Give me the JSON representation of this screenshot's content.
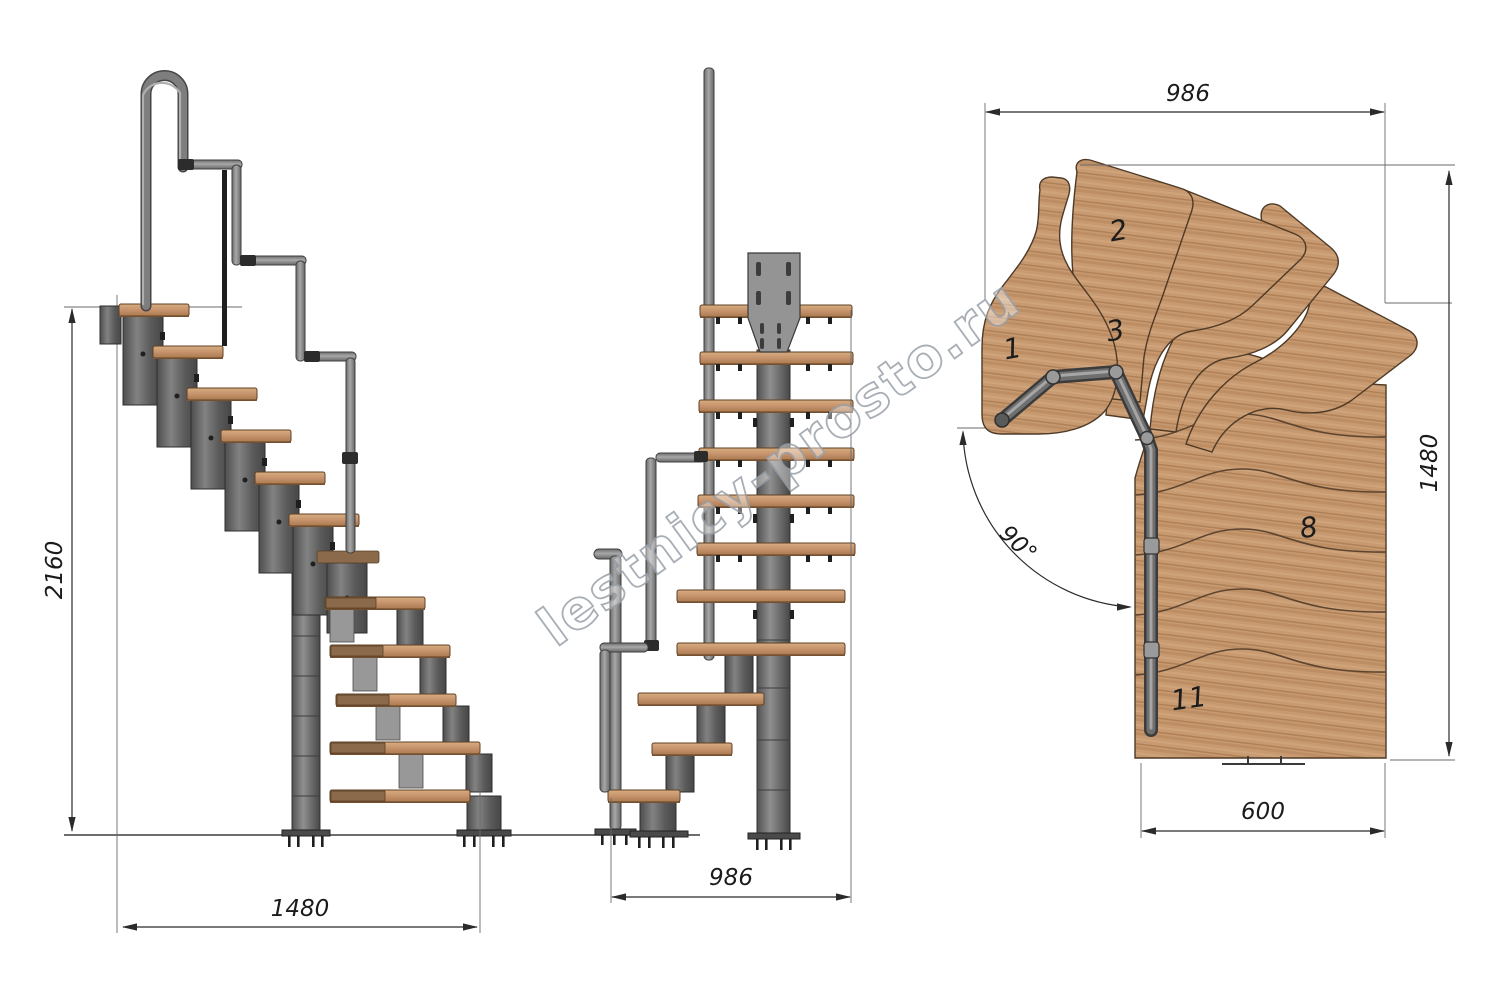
{
  "watermark": "lestnicy-prosto.ru",
  "side_view": {
    "height_mm": "2160",
    "run_mm": "1480"
  },
  "front_view": {
    "width_mm": "986"
  },
  "plan_view": {
    "width_mm": "986",
    "depth_mm": "1480",
    "lower_flight_width_mm": "600",
    "turn_angle": "90°",
    "step_numbers": [
      "1",
      "2",
      "3",
      "8",
      "11"
    ]
  },
  "colors": {
    "wood": "#c89b72",
    "metal": "#6e6e6e",
    "dimension_lines": "#2b2b2b"
  }
}
